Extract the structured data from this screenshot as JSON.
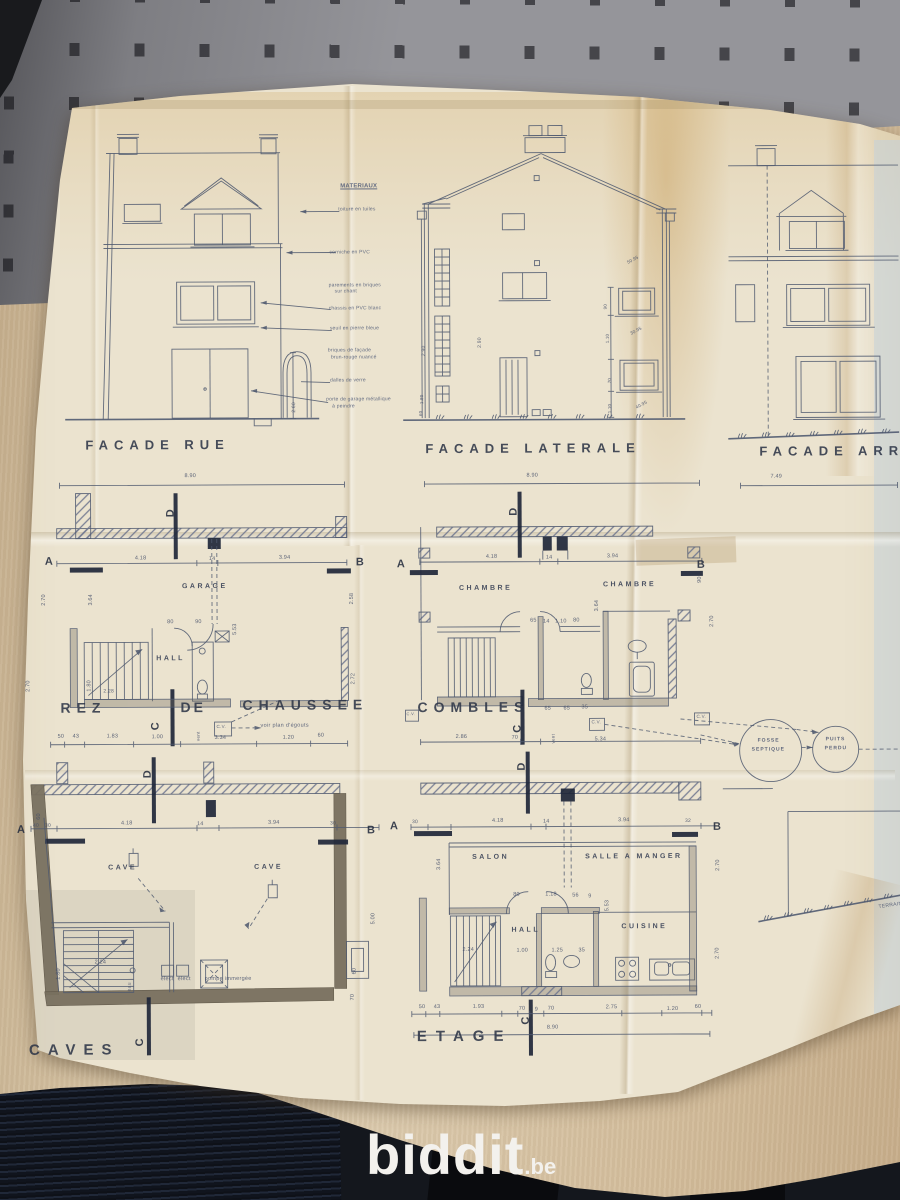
{
  "watermark": {
    "brand": "biddit",
    "tld": ".be"
  },
  "palette": {
    "paper": "#ebe3cf",
    "ink": "#505a70",
    "wall": "#95959a",
    "wallslot": "#45454a",
    "desk": "#d5c2a3",
    "floor": "#14171d",
    "logo": "#f3f1ed",
    "title": "#2d3547"
  },
  "drawing_titles": [
    {
      "t": "FACADE RUE",
      "x": 86,
      "y": 437
    },
    {
      "t": "FACADE LATERALE",
      "x": 426,
      "y": 442
    },
    {
      "t": "FACADE ARR",
      "x": 760,
      "y": 446
    },
    {
      "t": "REZ",
      "x": 60,
      "y": 699,
      "s": 14
    },
    {
      "t": "DE",
      "x": 180,
      "y": 699,
      "s": 14,
      "ls": 3
    },
    {
      "t": "CHAUSSEE",
      "x": 242,
      "y": 697,
      "s": 14
    },
    {
      "t": "COMBLES",
      "x": 417,
      "y": 700,
      "s": 14
    },
    {
      "t": "CAVES",
      "x": 27,
      "y": 1041,
      "s": 15,
      "ls": 8
    },
    {
      "t": "ETAGE",
      "x": 415,
      "y": 1029,
      "s": 15,
      "ls": 9
    }
  ],
  "section_letters": [
    {
      "t": "A",
      "x": 45,
      "y": 555
    },
    {
      "t": "B",
      "x": 356,
      "y": 557
    },
    {
      "t": "D",
      "x": 166,
      "y": 516,
      "r": -90
    },
    {
      "t": "C",
      "x": 150,
      "y": 729,
      "r": -90
    },
    {
      "t": "A",
      "x": 397,
      "y": 559
    },
    {
      "t": "B",
      "x": 697,
      "y": 561
    },
    {
      "t": "D",
      "x": 509,
      "y": 516,
      "r": -90
    },
    {
      "t": "C",
      "x": 512,
      "y": 733,
      "r": -90
    },
    {
      "t": "A",
      "x": 16,
      "y": 823
    },
    {
      "t": "B",
      "x": 366,
      "y": 825
    },
    {
      "t": "D",
      "x": 142,
      "y": 777,
      "r": -90
    },
    {
      "t": "C",
      "x": 133,
      "y": 1045,
      "r": -90
    },
    {
      "t": "A",
      "x": 389,
      "y": 821
    },
    {
      "t": "B",
      "x": 712,
      "y": 823
    },
    {
      "t": "D",
      "x": 516,
      "y": 771,
      "r": -90
    },
    {
      "t": "C",
      "x": 519,
      "y": 1025,
      "r": -90
    }
  ],
  "room_labels": [
    {
      "t": "GARAGE",
      "x": 182,
      "y": 582
    },
    {
      "t": "HALL",
      "x": 156,
      "y": 654
    },
    {
      "t": "CHAMBRE",
      "x": 459,
      "y": 585
    },
    {
      "t": "CHAMBRE",
      "x": 603,
      "y": 582
    },
    {
      "t": "CAVE",
      "x": 107,
      "y": 863
    },
    {
      "t": "CAVE",
      "x": 253,
      "y": 863
    },
    {
      "t": "SALON",
      "x": 471,
      "y": 854
    },
    {
      "t": "SALLE A MANGER",
      "x": 584,
      "y": 854
    },
    {
      "t": "HALL",
      "x": 510,
      "y": 927
    },
    {
      "t": "CUISINE",
      "x": 620,
      "y": 924
    }
  ],
  "annotations": [
    {
      "t": "FOSSE",
      "x": 757,
      "y": 740,
      "s": 5,
      "w": 700,
      "ls": 1
    },
    {
      "t": "SEPTIQUE",
      "x": 751,
      "y": 749,
      "s": 5,
      "w": 700,
      "ls": 1
    },
    {
      "t": "PUITS",
      "x": 825,
      "y": 739,
      "s": 5,
      "w": 700,
      "ls": 1
    },
    {
      "t": "PERDU",
      "x": 824,
      "y": 748,
      "s": 5,
      "w": 700,
      "ls": 1
    },
    {
      "t": "pompe immergée",
      "x": 203,
      "y": 976,
      "s": 5.5
    },
    {
      "t": "élect",
      "x": 159,
      "y": 976,
      "s": 5.5
    },
    {
      "t": "élect",
      "x": 176,
      "y": 976,
      "s": 5.5
    },
    {
      "t": "eau",
      "x": 126,
      "y": 990,
      "s": 5,
      "r": -90
    },
    {
      "t": "voir plan d'égouts",
      "x": 260,
      "y": 723,
      "s": 5.5
    },
    {
      "t": "vent",
      "x": 196,
      "y": 740,
      "s": 4.5,
      "r": -90
    },
    {
      "t": "vent",
      "x": 551,
      "y": 744,
      "s": 4.5,
      "r": -90
    },
    {
      "t": "C.V.",
      "x": 216,
      "y": 724,
      "s": 4.5
    },
    {
      "t": "C.V.",
      "x": 591,
      "y": 721,
      "s": 4.5
    },
    {
      "t": "C.V.",
      "x": 696,
      "y": 716,
      "s": 4.5
    },
    {
      "t": "C.V.",
      "x": 406,
      "y": 712,
      "s": 4
    },
    {
      "t": "TERRAIN",
      "x": 877,
      "y": 907,
      "s": 5,
      "r": -8
    }
  ],
  "materials_list": [
    {
      "t": "MATERIAUX",
      "x": 342,
      "y": 183,
      "s": 6,
      "w": 700,
      "u": 1
    },
    {
      "t": "toiture en tuiles",
      "x": 340,
      "y": 207
    },
    {
      "t": "corniche en PVC",
      "x": 331,
      "y": 250
    },
    {
      "t": "parements en briques",
      "x": 330,
      "y": 283
    },
    {
      "t": "sur chant",
      "x": 336,
      "y": 289
    },
    {
      "t": "chassis en PVC blanc",
      "x": 330,
      "y": 306
    },
    {
      "t": "seuil en pierre bleue",
      "x": 331,
      "y": 326
    },
    {
      "t": "briques de façade",
      "x": 329,
      "y": 348
    },
    {
      "t": "brun-rouge nuancé",
      "x": 332,
      "y": 355
    },
    {
      "t": "dalles de verre",
      "x": 331,
      "y": 378
    },
    {
      "t": "porte de garage métallique",
      "x": 327,
      "y": 397
    },
    {
      "t": "à peindre",
      "x": 333,
      "y": 404
    }
  ],
  "dimensions": [
    {
      "t": "8.90",
      "x": 185,
      "y": 473
    },
    {
      "t": "8.90",
      "x": 527,
      "y": 474
    },
    {
      "t": "7.49",
      "x": 771,
      "y": 476
    },
    {
      "t": "4.18",
      "x": 135,
      "y": 555
    },
    {
      "t": "14",
      "x": 209,
      "y": 556
    },
    {
      "t": "3.94",
      "x": 279,
      "y": 555
    },
    {
      "t": "2.70",
      "x": 42,
      "y": 604,
      "r": -90
    },
    {
      "t": "3.64",
      "x": 89,
      "y": 604,
      "r": -90
    },
    {
      "t": "5.53",
      "x": 233,
      "y": 634,
      "r": -90
    },
    {
      "t": "2.58",
      "x": 350,
      "y": 604,
      "r": -90
    },
    {
      "t": "2.72",
      "x": 351,
      "y": 684,
      "r": -90
    },
    {
      "t": "2.70",
      "x": 26,
      "y": 690,
      "r": -90
    },
    {
      "t": "1.80",
      "x": 87,
      "y": 690,
      "r": -90
    },
    {
      "t": "2.28",
      "x": 103,
      "y": 688,
      "s": 5
    },
    {
      "t": "80",
      "x": 167,
      "y": 619
    },
    {
      "t": "90",
      "x": 195,
      "y": 619
    },
    {
      "t": "50",
      "x": 57,
      "y": 733
    },
    {
      "t": "43",
      "x": 72,
      "y": 733
    },
    {
      "t": "1.83",
      "x": 106,
      "y": 733
    },
    {
      "t": "1.00",
      "x": 151,
      "y": 734
    },
    {
      "t": "3.34",
      "x": 214,
      "y": 735
    },
    {
      "t": "1.20",
      "x": 282,
      "y": 735
    },
    {
      "t": "60",
      "x": 317,
      "y": 733
    },
    {
      "t": "4.18",
      "x": 486,
      "y": 555
    },
    {
      "t": "14",
      "x": 546,
      "y": 556
    },
    {
      "t": "3.94",
      "x": 607,
      "y": 555
    },
    {
      "t": "3.64",
      "x": 595,
      "y": 612,
      "r": -90
    },
    {
      "t": "65",
      "x": 530,
      "y": 619
    },
    {
      "t": "14",
      "x": 543,
      "y": 620
    },
    {
      "t": "1.10",
      "x": 555,
      "y": 620
    },
    {
      "t": "80",
      "x": 573,
      "y": 619
    },
    {
      "t": "65",
      "x": 544,
      "y": 707
    },
    {
      "t": "65",
      "x": 563,
      "y": 707
    },
    {
      "t": "35",
      "x": 581,
      "y": 706
    },
    {
      "t": "2.86",
      "x": 455,
      "y": 735
    },
    {
      "t": "70",
      "x": 511,
      "y": 736
    },
    {
      "t": "5.34",
      "x": 594,
      "y": 738
    },
    {
      "t": "90",
      "x": 698,
      "y": 584,
      "r": -90
    },
    {
      "t": "2.70",
      "x": 710,
      "y": 628,
      "r": -90
    },
    {
      "t": "40",
      "x": 32,
      "y": 822,
      "s": 5
    },
    {
      "t": "30",
      "x": 44,
      "y": 822,
      "s": 5
    },
    {
      "t": "4.18",
      "x": 120,
      "y": 820
    },
    {
      "t": "14",
      "x": 196,
      "y": 821
    },
    {
      "t": "3.94",
      "x": 267,
      "y": 820
    },
    {
      "t": "30",
      "x": 329,
      "y": 821,
      "s": 5
    },
    {
      "t": "2.24",
      "x": 93,
      "y": 959
    },
    {
      "t": "5.00",
      "x": 370,
      "y": 924,
      "r": -90
    },
    {
      "t": "60",
      "x": 351,
      "y": 974,
      "r": -90
    },
    {
      "t": "70",
      "x": 349,
      "y": 1000,
      "r": -90
    },
    {
      "t": "1.80",
      "x": 55,
      "y": 978,
      "r": -90
    },
    {
      "t": "60",
      "x": 36,
      "y": 818,
      "r": -90
    },
    {
      "t": "30",
      "x": 411,
      "y": 820,
      "s": 5
    },
    {
      "t": "4.18",
      "x": 491,
      "y": 819
    },
    {
      "t": "14",
      "x": 542,
      "y": 820
    },
    {
      "t": "3.94",
      "x": 617,
      "y": 819
    },
    {
      "t": "32",
      "x": 684,
      "y": 820,
      "s": 5
    },
    {
      "t": "3.64",
      "x": 436,
      "y": 870,
      "r": -90
    },
    {
      "t": "5.53",
      "x": 604,
      "y": 912,
      "r": -90
    },
    {
      "t": "2.70",
      "x": 715,
      "y": 872,
      "r": -90
    },
    {
      "t": "2.70",
      "x": 714,
      "y": 960,
      "r": -90
    },
    {
      "t": "80",
      "x": 512,
      "y": 893
    },
    {
      "t": "1.18",
      "x": 544,
      "y": 893
    },
    {
      "t": "56",
      "x": 571,
      "y": 894
    },
    {
      "t": "9",
      "x": 587,
      "y": 895
    },
    {
      "t": "2.24",
      "x": 461,
      "y": 948
    },
    {
      "t": "1.00",
      "x": 515,
      "y": 949
    },
    {
      "t": "1.25",
      "x": 550,
      "y": 949
    },
    {
      "t": "35",
      "x": 577,
      "y": 949
    },
    {
      "t": "50",
      "x": 417,
      "y": 1005
    },
    {
      "t": "43",
      "x": 432,
      "y": 1005
    },
    {
      "t": "1.93",
      "x": 471,
      "y": 1005
    },
    {
      "t": "70",
      "x": 517,
      "y": 1007
    },
    {
      "t": "9",
      "x": 533,
      "y": 1008
    },
    {
      "t": "70",
      "x": 546,
      "y": 1007
    },
    {
      "t": "2.75",
      "x": 604,
      "y": 1006
    },
    {
      "t": "1.20",
      "x": 665,
      "y": 1008
    },
    {
      "t": "60",
      "x": 693,
      "y": 1006
    },
    {
      "t": "8.90",
      "x": 545,
      "y": 1026
    },
    {
      "t": "2.60",
      "x": 293,
      "y": 412,
      "r": -90,
      "s": 5
    },
    {
      "t": "2.90",
      "x": 423,
      "y": 356,
      "r": -90,
      "s": 5
    },
    {
      "t": "1.80",
      "x": 421,
      "y": 404,
      "r": -90,
      "s": 4.5
    },
    {
      "t": "60",
      "x": 420,
      "y": 416,
      "r": -90,
      "s": 4.5
    },
    {
      "t": "2.90",
      "x": 479,
      "y": 348,
      "r": -90,
      "s": 5
    },
    {
      "t": "90",
      "x": 605,
      "y": 310,
      "r": -90,
      "s": 4.5
    },
    {
      "t": "1.10",
      "x": 607,
      "y": 344,
      "r": -90,
      "s": 4.5
    },
    {
      "t": "70",
      "x": 609,
      "y": 384,
      "r": -90,
      "s": 4.5
    },
    {
      "t": "1.10",
      "x": 609,
      "y": 414,
      "r": -90,
      "s": 4.5
    },
    {
      "t": "50.95",
      "x": 628,
      "y": 262,
      "r": -28,
      "s": 4.5
    },
    {
      "t": "30.95",
      "x": 631,
      "y": 333,
      "r": -28,
      "s": 4.5
    },
    {
      "t": "40.95",
      "x": 636,
      "y": 407,
      "r": -28,
      "s": 4.5
    }
  ]
}
